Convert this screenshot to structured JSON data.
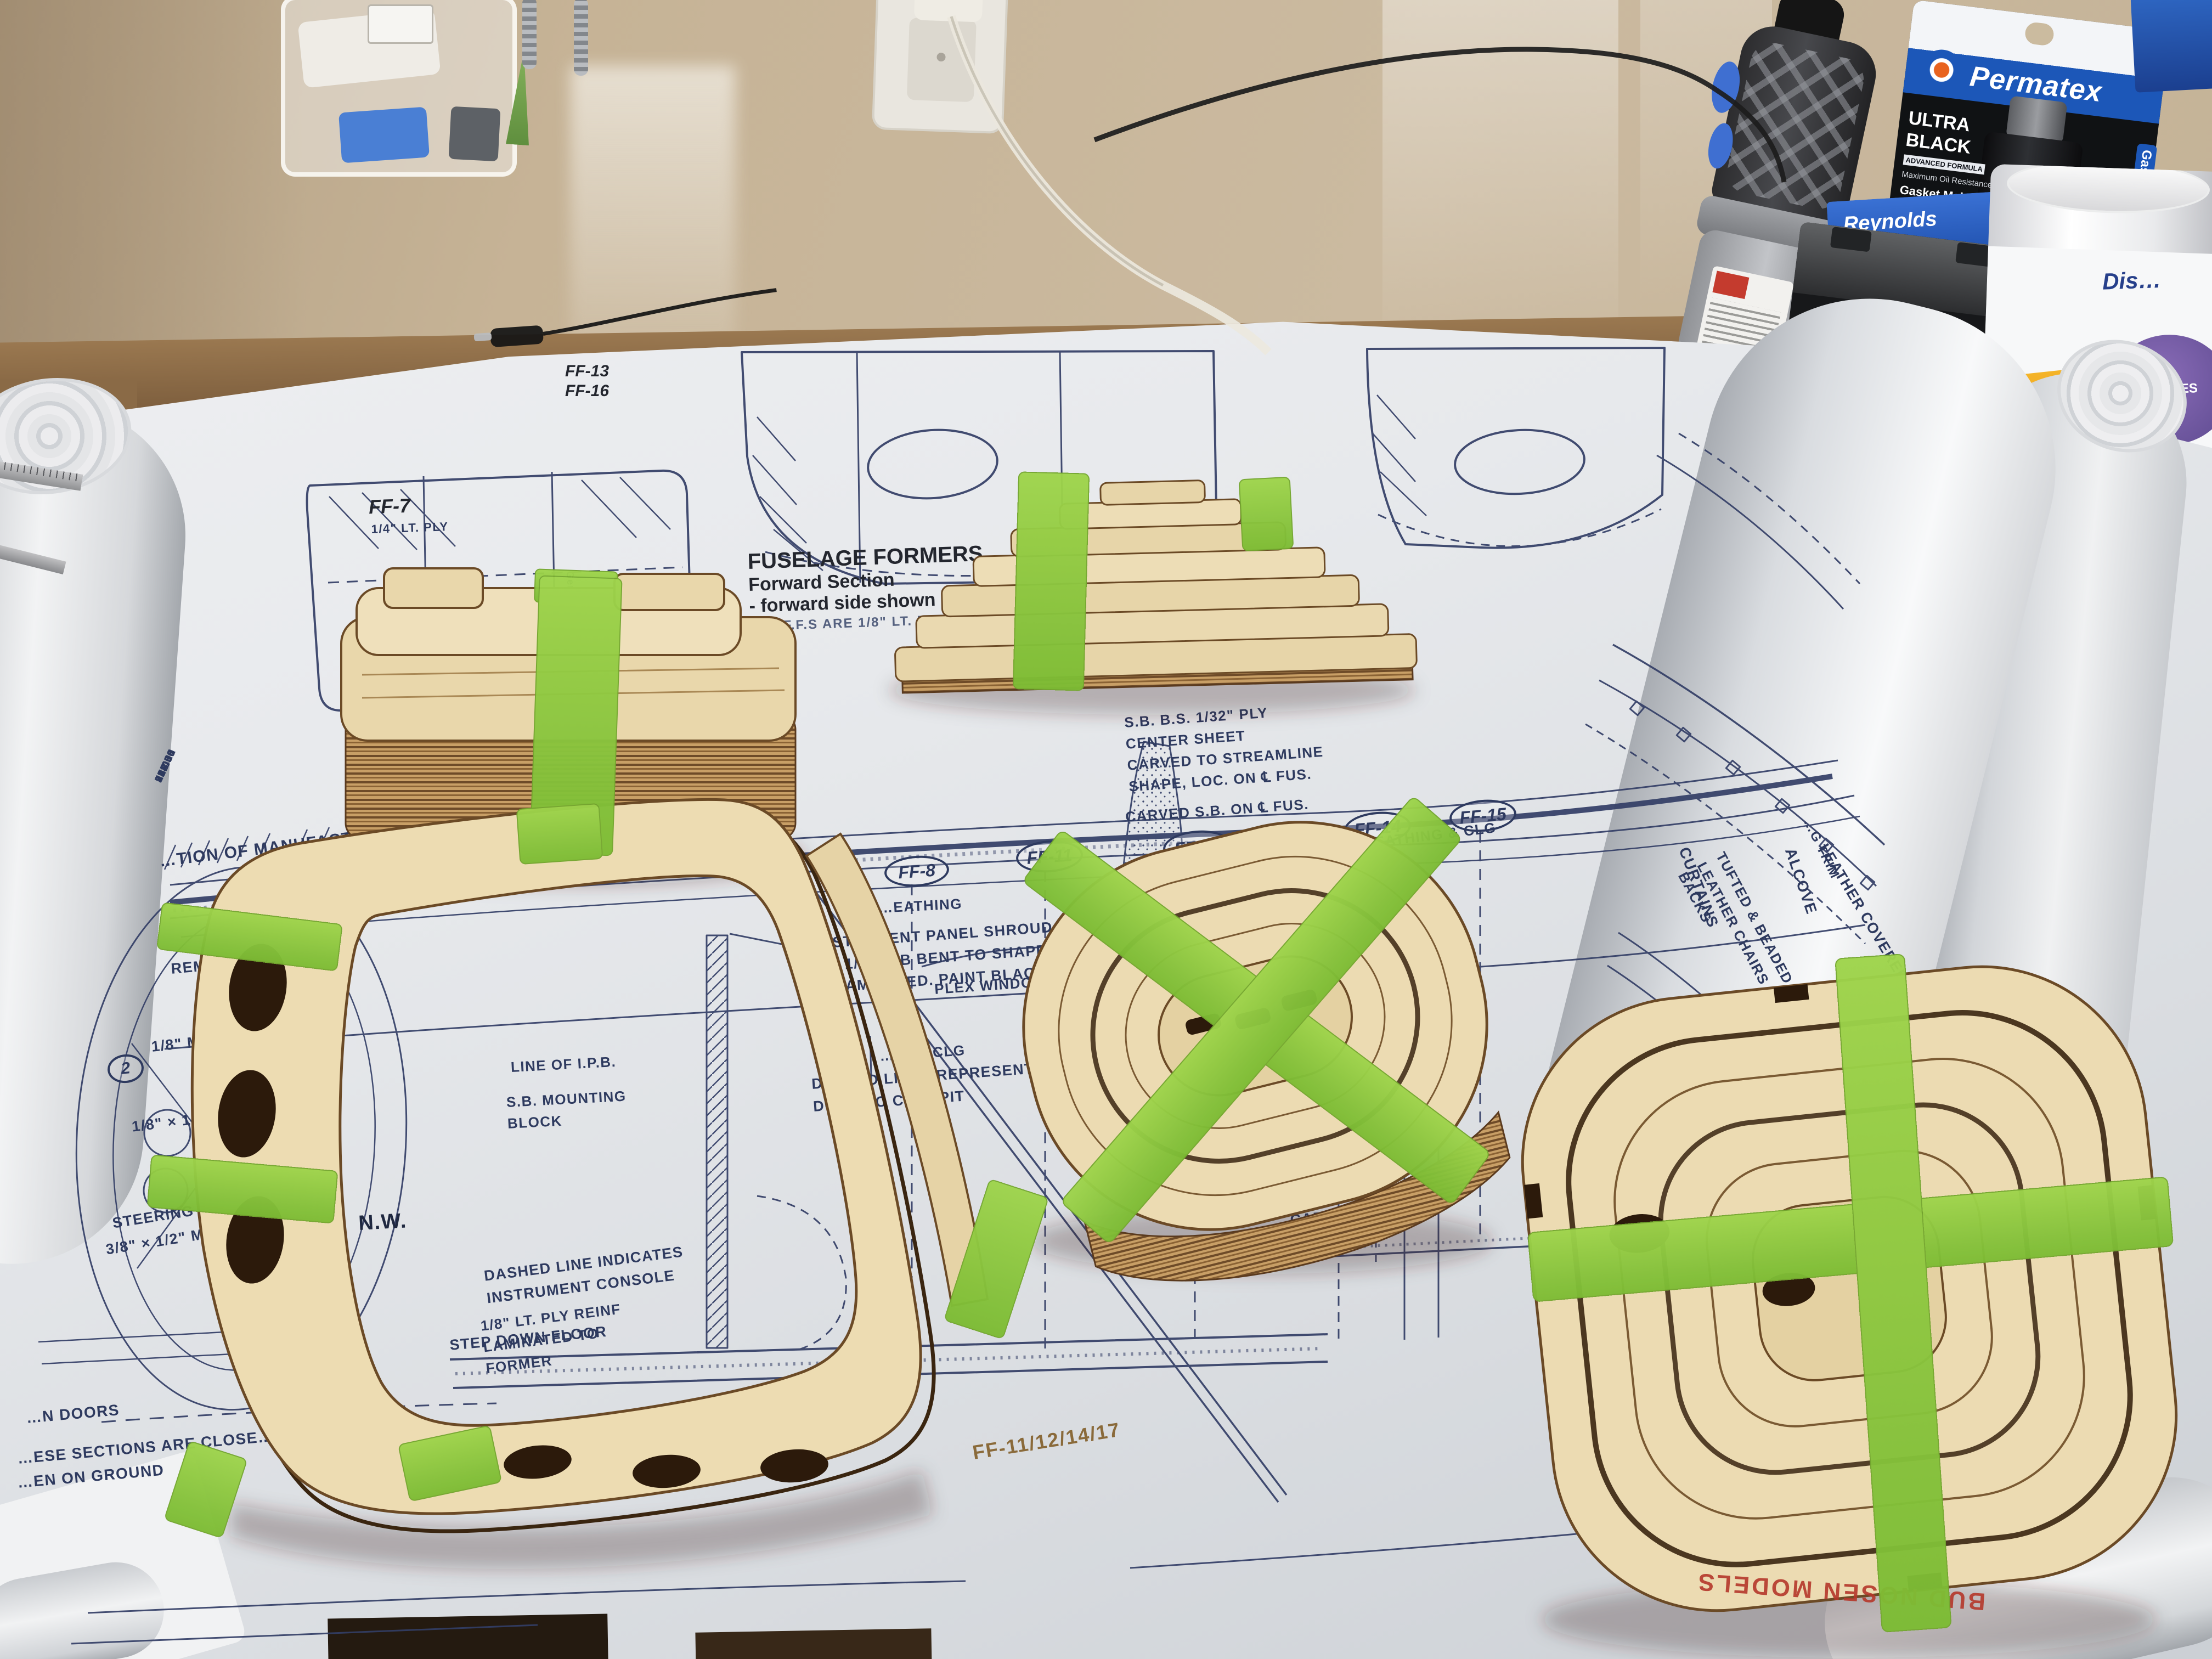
{
  "plan": {
    "title_block": {
      "title": "FUSELAGE FORMERS",
      "line2": "Forward Section",
      "line3": "- forward side shown u.n.o.",
      "line4": "ALL F.F.S ARE 1/8\" LT. PLY, U.N.O."
    },
    "corner_refs": {
      "ref1": "FF-13",
      "ref2": "FF-16"
    },
    "former_ovals": [
      {
        "label": "FF-8"
      },
      {
        "label": "FF-11"
      },
      {
        "label": "FF-12"
      },
      {
        "label": "FF-14"
      },
      {
        "label": "FF-15"
      }
    ],
    "section_label": "FF-7",
    "section_ply_note": "1/4\" LT. PLY",
    "stations_caption": "…TION OF MANUFACTURER'S STATIONS",
    "station_numbers": [
      "76.00",
      "85.40",
      "94.00",
      "106.31",
      "118.50",
      "134.81",
      "143.15",
      "150.00",
      "198.00",
      "207.88",
      "216.00",
      "234.00",
      "252.00",
      "272.50",
      "292.60",
      "312.83",
      "335.58",
      "355.1"
    ],
    "sub_station_numbers": [
      "17.25",
      "26.50",
      "35.75",
      "45.00"
    ],
    "general_info_note": "General Section Information",
    "annotations": {
      "center_sheet": "S.B. B.S. 1/32\" PLY\nCENTER SHEET\nCARVED TO STREAMLINE\nSHAPE, LOC. ON ℄ FUS.",
      "carved_sb": "CARVED S.B. ON ℄ FUS.",
      "birch_sheathing": "1/64\" BIRCH PLY SHEATHING & CLG",
      "sheathing_fragment": "…EATHING",
      "plex_window": "PLEX WINDOW B.S.",
      "valence": "…OT. OF VALENCE",
      "birch_clg": "…RCH CLG",
      "rem_access": "REM ACCESS PAN…",
      "mb_sheathing": "1/8\" MB SHEATHIN…",
      "ref_partial": "2",
      "ftk": "1/8\" × 1/4\" F.T.K. EA. S…",
      "steering": "STEERING CABLE",
      "maple": "3/8\" × 1/2\" MAPLE R.M…",
      "nw": "N.W.",
      "doors": "…N DOORS",
      "sections_close": "…ESE SECTIONS ARE CLOSE…",
      "on_ground": "…EN ON GROUND",
      "line_ipb": "LINE OF I.P.B.",
      "sb_mounting": "S.B. MOUNTING\nBLOCK",
      "instrument_console": "DASHED LINE INDICATES\nINSTRUMENT CONSOLE",
      "ply_reinf": "1/8\" LT. PLY REINF\nLAMINATED TO\nFORMER",
      "step_down_floor": "STEP DOWN FLOOR",
      "instrument_shroud": "INSTRUMENT PANEL SHROUD\nOF 1/16\" SB BENT TO SHAPE\n& LAMINATED. PAINT BLACK",
      "door_cockpit": "DASHED LINES REPRESENT\nDOOR TO COCKPIT",
      "cabin_floor": "CABIN FLR 1/16\"",
      "curtains": "CURTAINS",
      "tufted_chairs": "TUFTED & BEADED\nLEATHER CHAIRS\nBACKS",
      "alcove": "ALCOVE",
      "g_trim": "…G TRIM",
      "leather_panel": "LEATHER COVERED PAN…"
    }
  },
  "wood": {
    "etched_id": "FF-11/12/14/17",
    "stamp": "BUD NOSEN MODELS"
  },
  "products": {
    "permatex": {
      "brand": "Permatex",
      "tab": "Gasketing",
      "card": [
        "ULTRA",
        "BLACK",
        "ADVANCED FORMULA",
        "Maximum Oil Resistance",
        "Gasket Maker",
        "…5°F to 500°F",
        "(-54°C to 260°C)",
        "intermittent",
        "Heavy Duty",
        "Oil Applications",
        "Ideal for Domestic",
        "Vehicles",
        "Sensor Safe",
        "#82180",
        "NET WT. 3.35 OZ.",
        "CONT. NET. 95 g"
      ],
      "tube": [
        "ULTRA BLACK",
        "Gasket Maker",
        "Permatex"
      ]
    },
    "wax_paper": {
      "brand": "Reynolds",
      "product": "CUT-RITE",
      "sub": "WAX PAPER",
      "size": "76 SQ FT"
    },
    "wipes": {
      "line1": "Dis…",
      "line2": "75 WIPES"
    },
    "battery": {
      "fragment": "…TER"
    }
  },
  "colors": {
    "tape_green": "#8ec93e",
    "wood_top": "#ecdcb4",
    "wood_edge": "#6b4a26",
    "plan_ink": "#333e66",
    "paper": "#eceef0",
    "wall": "#c6b396",
    "permatex_blue": "#1c57b8",
    "reynolds_blue": "#1d47a8",
    "cutrite_yellow": "#f5c518",
    "stamp_red": "#b5382b"
  }
}
